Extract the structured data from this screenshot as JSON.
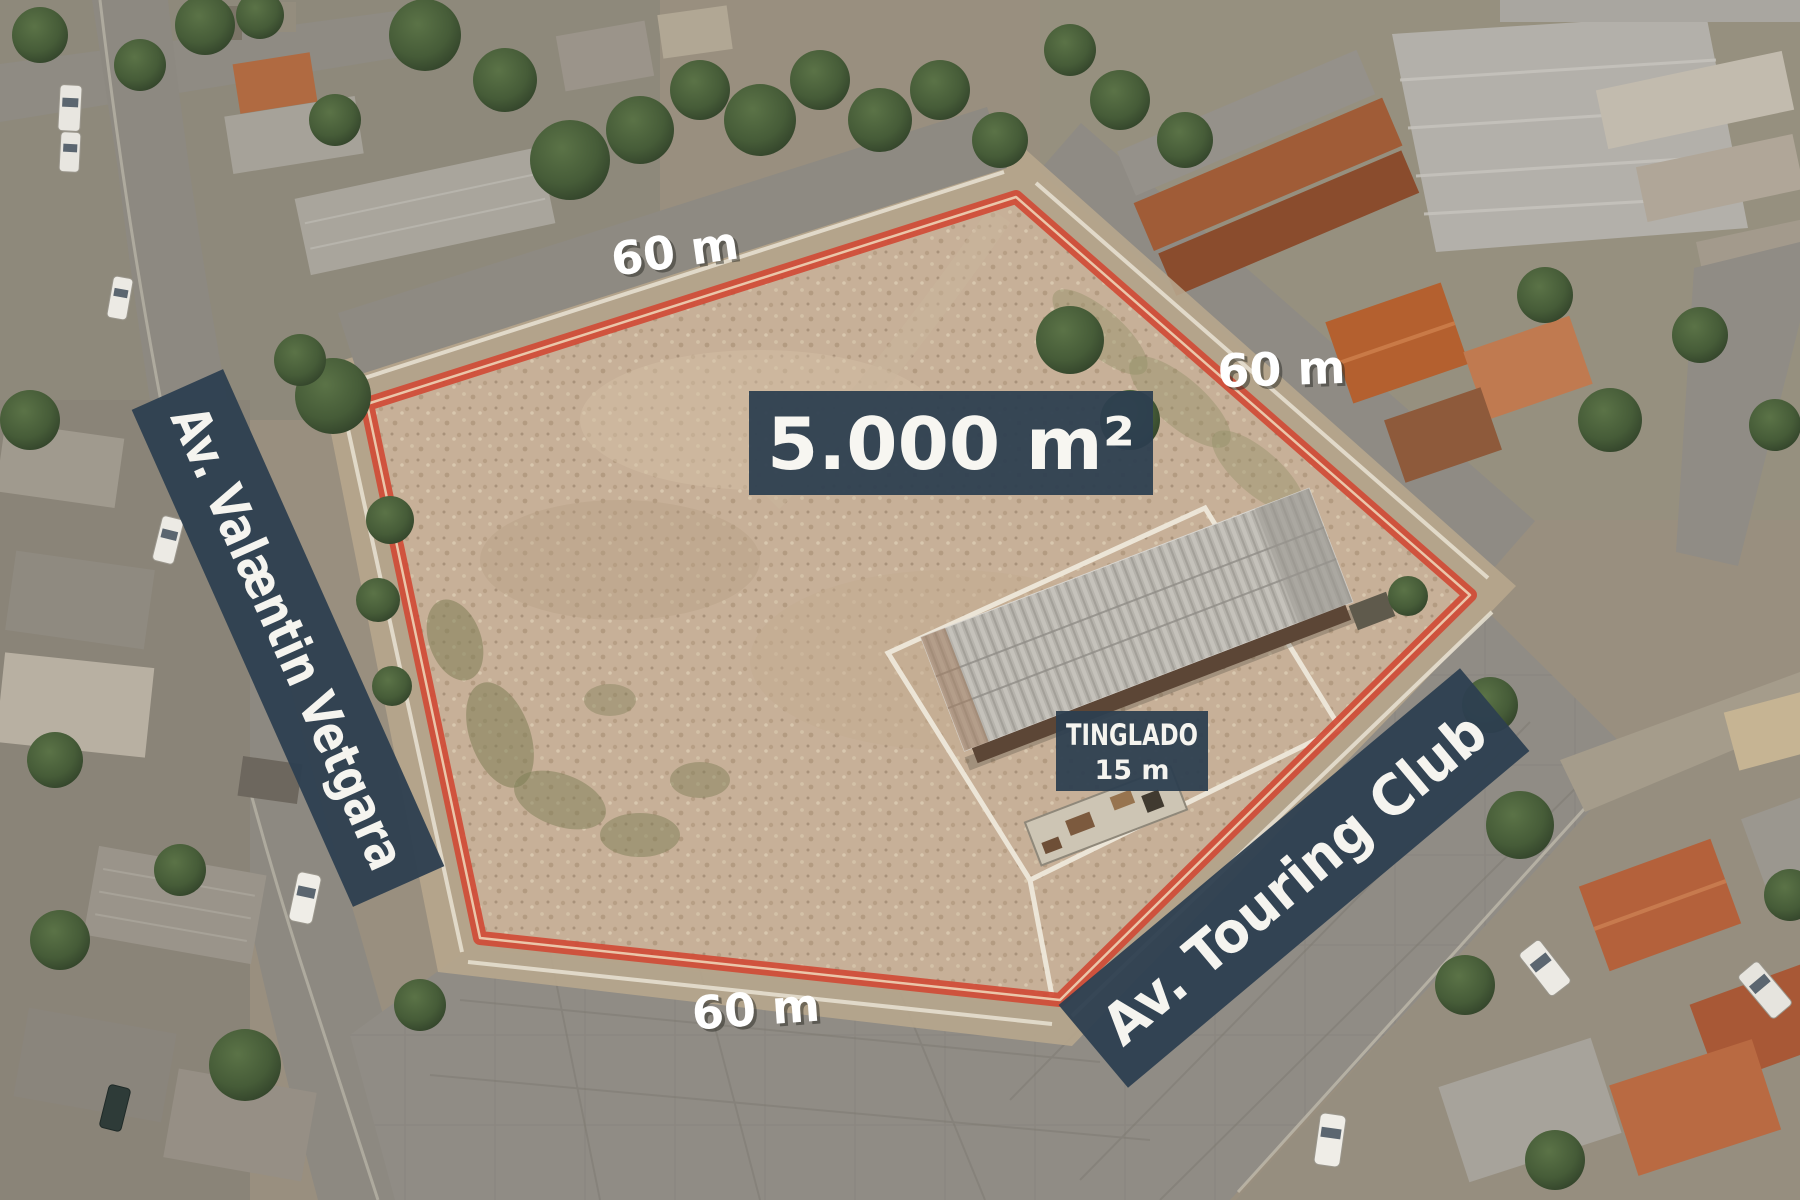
{
  "labels": {
    "area": "5.000 m²",
    "side_top": "60 m",
    "side_right": "60 m",
    "side_bottom": "60 m",
    "shed_title": "TINGLADO",
    "shed_length": "15 m",
    "street_left": "Av. Valæntin Vetgara",
    "street_right": "Av. Touring Club"
  },
  "colors": {
    "badge_navy": "#2d3f50",
    "boundary_red": "#d04b36",
    "label_white": "#f5f4ef"
  }
}
